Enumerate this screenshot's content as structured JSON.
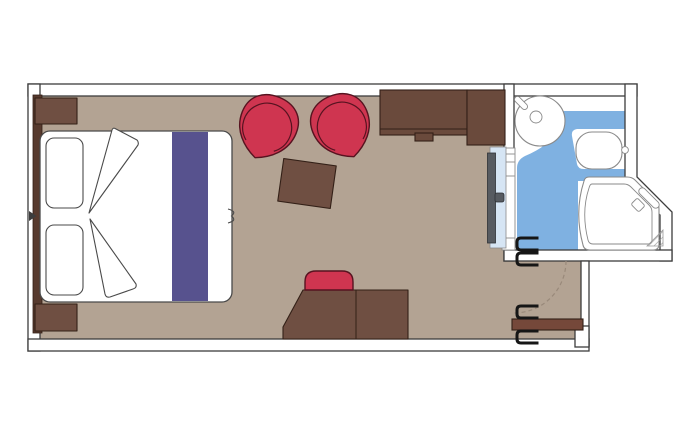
{
  "title": "Cruise cabin floor plan",
  "colors": {
    "page_bg": "#ffffff",
    "floor": "#b3a393",
    "wall_fill": "#ffffff",
    "wall_stroke": "#3d3d3d",
    "bed_stroke": "#4a4a4a",
    "wood": "#6f4f42",
    "wood_stroke": "#332017",
    "wardrobe": "#6a4a3c",
    "headboard": "#573a2e",
    "door_wood": "#75483a",
    "chair_red": "#cf3550",
    "chair_stroke": "#571320",
    "runner_purple": "#57528e",
    "bath_blue": "#7fb1e1",
    "fixture_stroke": "#8a8a8a",
    "mirror_blue": "#d6e5f4",
    "slider_gray": "#575b61",
    "handle_black": "#161616",
    "arc_dash": "#99897a"
  },
  "rooms": [
    {
      "id": "cabin",
      "label": "main cabin"
    },
    {
      "id": "bathroom",
      "label": "bathroom with wet floor"
    },
    {
      "id": "entry",
      "label": "entry corridor"
    }
  ],
  "furniture": [
    "double-bed",
    "pillow x2",
    "folded-duvet x2",
    "bed-runner",
    "nightstand x2",
    "headboard-panel",
    "armchair x2",
    "coffee-table",
    "wardrobe",
    "sliding-mirror-door",
    "desk",
    "stool",
    "entrance-door",
    "door-swing-arc",
    "door-handle x4",
    "washbasin",
    "tap-lever",
    "toilet",
    "flush-button",
    "shower",
    "shower-fixture",
    "shower-corner-seat",
    "bathroom-shelf"
  ]
}
